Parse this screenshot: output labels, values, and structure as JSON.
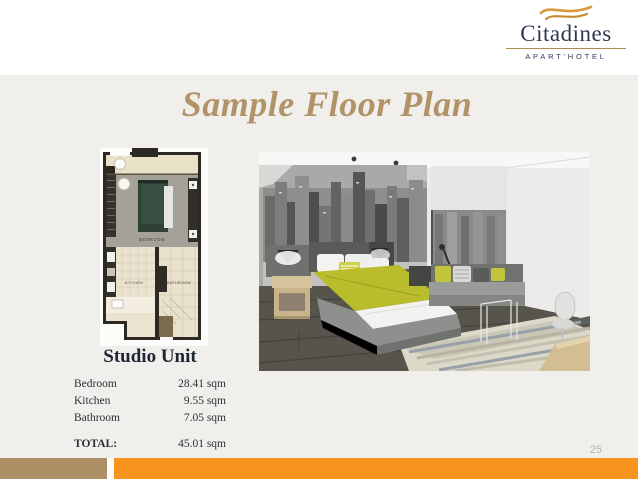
{
  "logo": {
    "name": "Citadines",
    "subtitle": "APART'HOTEL"
  },
  "title": "Sample Floor Plan",
  "floor_plan": {
    "labels": {
      "bedroom": "BEDROOM",
      "kitchen": "KITCHEN",
      "bathroom": "BATHROOM"
    }
  },
  "unit": {
    "heading": "Studio Unit",
    "rows": [
      {
        "label": "Bedroom",
        "value": "28.41 sqm"
      },
      {
        "label": "Kitchen",
        "value": "9.55 sqm"
      },
      {
        "label": "Bathroom",
        "value": "7.05 sqm"
      }
    ],
    "total": {
      "label": "TOTAL:",
      "value": "45.01 sqm"
    }
  },
  "page_number": "25",
  "colors": {
    "title_gold": "#b29367",
    "logo_navy": "#2c3950",
    "logo_wave_gold": "#d99a3f",
    "slide_gray": "#f0efec",
    "footer_tan": "#ac8f63",
    "footer_orange": "#f7941e",
    "bed_accent_green": "#b9bc2b",
    "plan_wall": "#2b2922",
    "plan_bed_green": "#2f4037"
  }
}
